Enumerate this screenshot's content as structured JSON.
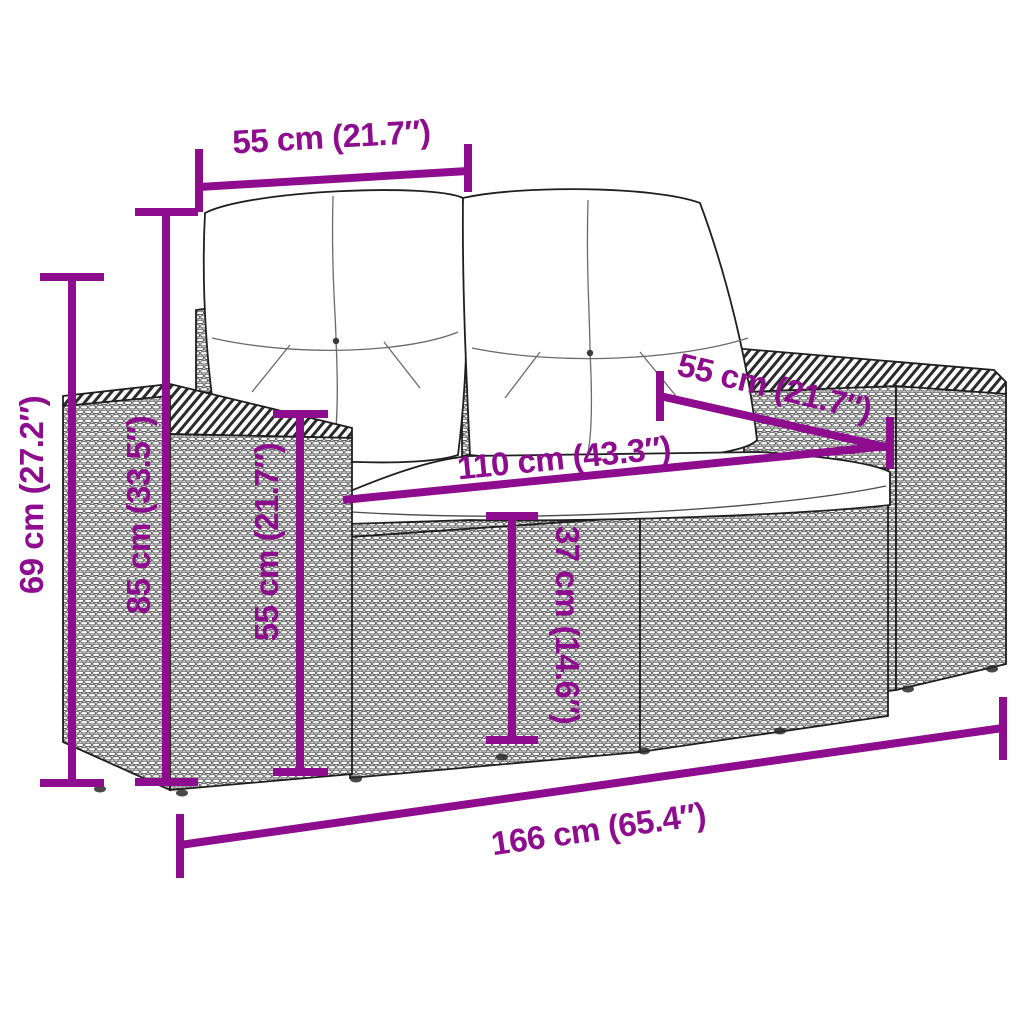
{
  "colors": {
    "dimension_line": "#8E0C8E",
    "line_art": "#1f1f1f",
    "cushion_fill": "#ffffff",
    "background": "#ffffff"
  },
  "product": {
    "type": "rattan-garden-loveseat-with-cushions"
  },
  "dimensions": {
    "top_horizontal": "55 cm (21.7″)",
    "right_diagonal": "55 cm (21.7″)",
    "middle_horizontal": "110 cm (43.3″)",
    "left_outer_vertical": "69 cm (27.2″)",
    "left_inner_vertical": "85 cm (33.5″)",
    "armrest_vertical": "55 cm (21.7″)",
    "center_vertical": "37 cm (14.6″)",
    "bottom_horizontal": "166 cm (65.4″)"
  }
}
